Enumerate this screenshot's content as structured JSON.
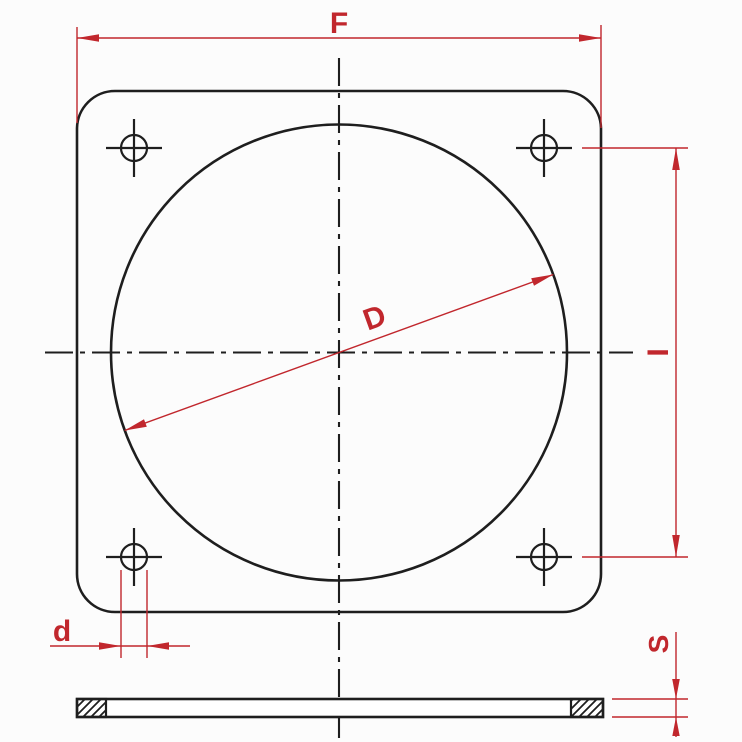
{
  "drawing": {
    "labels": {
      "flange_width": "F",
      "bore_diameter": "D",
      "bolt_hole_spacing": "I",
      "bolt_hole_diameter": "d",
      "plate_thickness": "S"
    },
    "colors": {
      "dimension": "#c1272d",
      "outline": "#1e1e1e",
      "background": "#fcfcfc"
    }
  }
}
